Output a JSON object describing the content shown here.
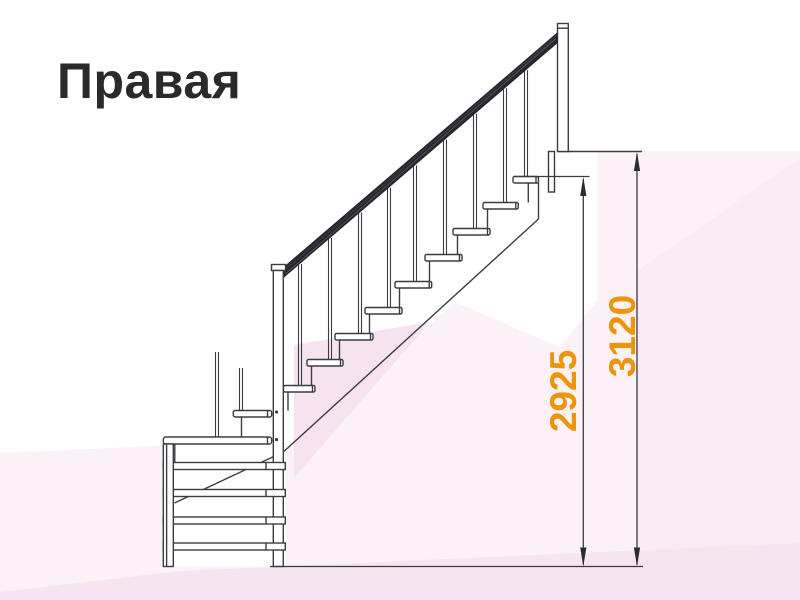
{
  "title": "Правая",
  "diagram": {
    "type": "staircase-side-view-drawing",
    "dimensions": [
      {
        "label": "2925",
        "orientation": "vertical",
        "measures": "height from floor to top tread surface"
      },
      {
        "label": "3120",
        "orientation": "vertical",
        "measures": "height from floor to upper floor level"
      }
    ]
  },
  "colors": {
    "accent": "#ee9408",
    "line": "#3b3b43",
    "handrail": "#27272e",
    "background_facet": "#fbf2f8"
  }
}
